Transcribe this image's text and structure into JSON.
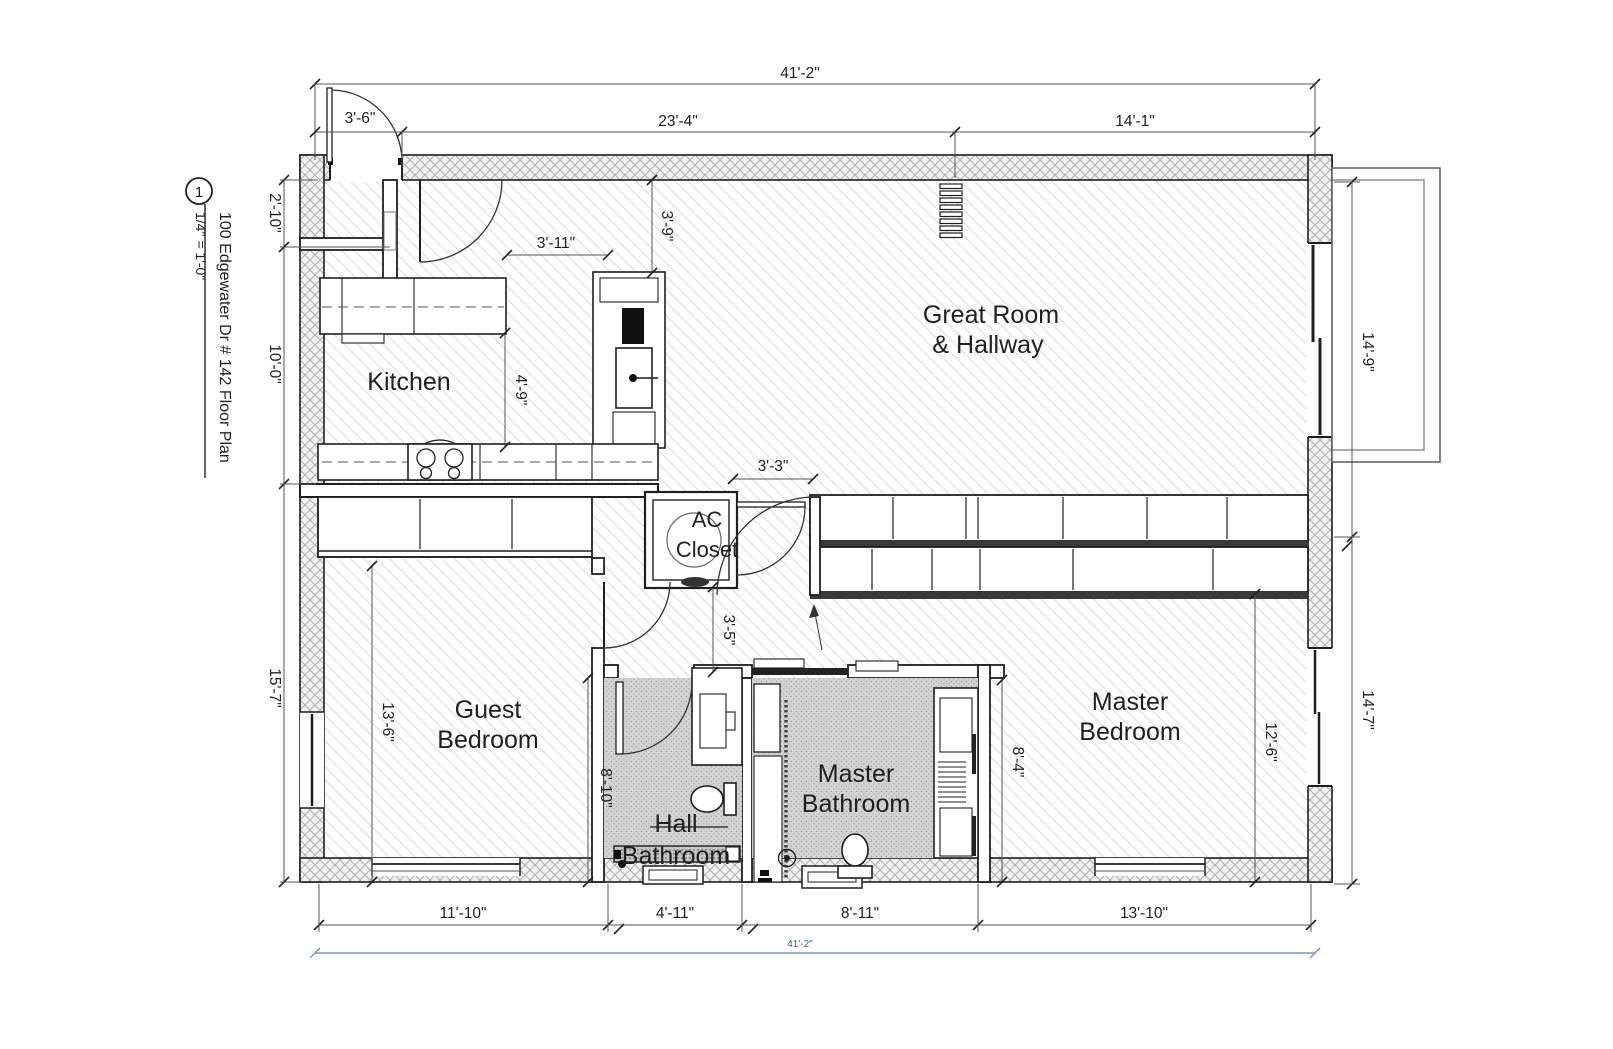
{
  "title_block": {
    "sheet_number": "1",
    "title": "100 Edgewater Dr # 142 Floor Plan",
    "scale": "1/4\" = 1'-0\""
  },
  "rooms": {
    "kitchen": "Kitchen",
    "great_room": [
      "Great Room",
      "& Hallway"
    ],
    "ac_closet": [
      "AC",
      "Closet"
    ],
    "guest_bedroom": [
      "Guest",
      "Bedroom"
    ],
    "master_bedroom": [
      "Master",
      "Bedroom"
    ],
    "master_bathroom": [
      "Master",
      "Bathroom"
    ],
    "hall_bathroom": [
      "Hall",
      "Bathroom"
    ]
  },
  "dimensions": {
    "overall_top": "41'-2\"",
    "top_left": "23'-4\"",
    "top_right": "14'-1\"",
    "entry": "3'-6\"",
    "left_entry_closet": "2'-10\"",
    "left_kitchen": "10'-0\"",
    "left_bedroom": "15'-7\"",
    "guest_width": "13'-6\"",
    "kitchen_aisle_w": "3'-11\"",
    "kitchen_top": "3'-9\"",
    "kitchen_aisle_h": "4'-9\"",
    "hall_opening": "3'-3\"",
    "hall_depth": "3'-5\"",
    "hall_bath_len": "8'-10\"",
    "master_bath_len": "8'-4\"",
    "master_bed_w": "12'-6\"",
    "right_upper": "14'-9\"",
    "right_lower": "14'-7\"",
    "bottom_guest": "11'-10\"",
    "bottom_hall_bath": "4'-11\"",
    "bottom_master_bath": "8'-11\"",
    "bottom_master_bed": "13'-10\"",
    "overall_bottom": "41'-2\""
  },
  "colors": {
    "line": "#1f1f1f",
    "floor_hatch": "#dcdcdc",
    "wall_hatch": "#b0b0b0",
    "bath_fill": "#d3d3d3",
    "dimension_blue": "#7d9bc1",
    "dimension_blue_text": "#3b5c94"
  }
}
